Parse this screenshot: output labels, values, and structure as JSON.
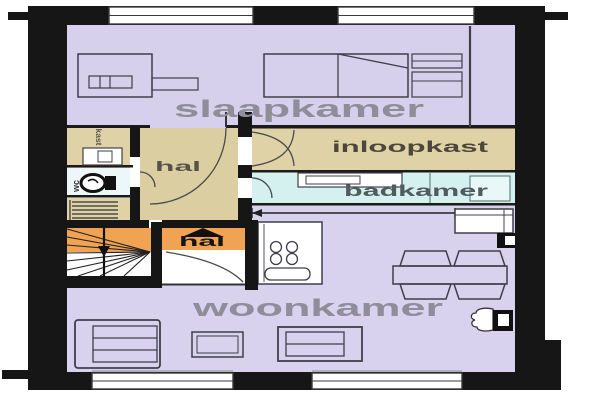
{
  "floorplan": {
    "type": "floor-plan",
    "rooms": {
      "slaapkamer": {
        "label": "slaapkamer",
        "color": "#d7d0ec"
      },
      "woonkamer": {
        "label": "woonkamer",
        "color": "#d8d2ee"
      },
      "hal": {
        "label": "hal",
        "color": "#dbcfa1"
      },
      "entree_hal": {
        "label": "hal",
        "color": "#f0a352"
      },
      "inloopkast": {
        "label": "inloopkast",
        "color": "#ded2a6"
      },
      "badkamer": {
        "label": "badkamer",
        "color": "#d4f1ef"
      },
      "kast": {
        "label": "kast",
        "color": "#ded2a6"
      },
      "wc": {
        "label": "wc",
        "color": "#edf6f9"
      }
    },
    "colors": {
      "wall": "#161616",
      "room_label": "#8e8d99",
      "hal_label": "#56524a",
      "closet_label": "#4b473a",
      "bath_label": "#515a5c",
      "entry_label": "#141414",
      "furniture_line": "#3f3f4a",
      "stairs_white": "#fdfdfd",
      "stairs_orange": "#f0a352"
    },
    "icons": {
      "entry_arrow": "up-arrow-icon",
      "stairs_arrow": "down-arrow-icon",
      "toilet": "toilet-icon",
      "stove": "stove-burners-icon",
      "radiator": "radiator-icon"
    }
  }
}
